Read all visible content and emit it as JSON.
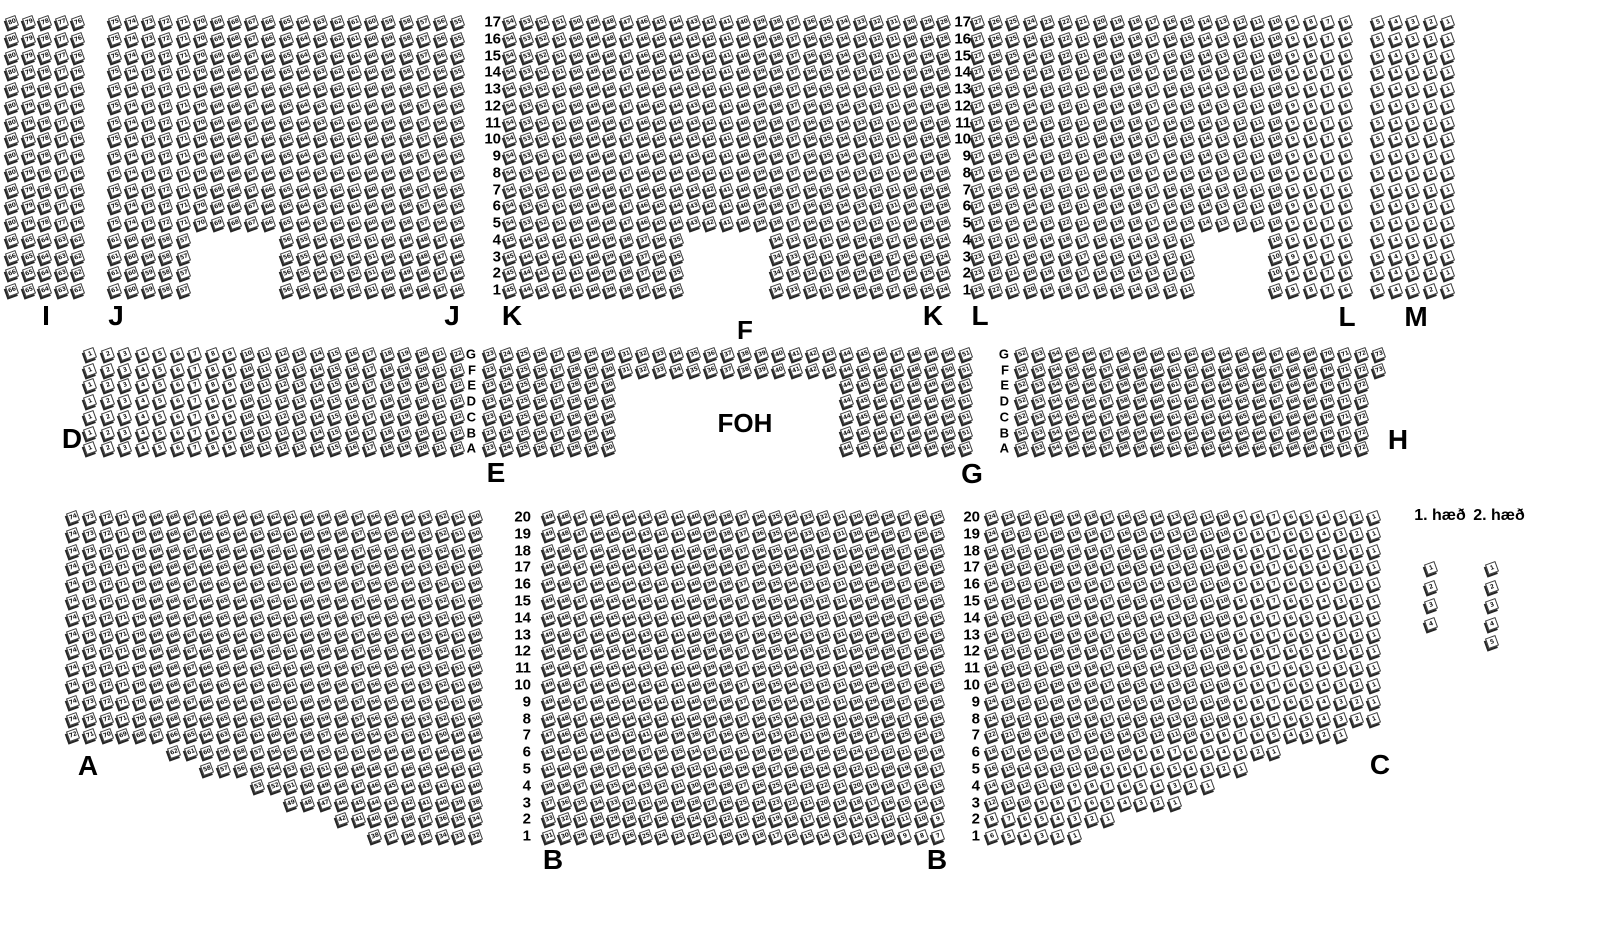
{
  "legend": {
    "floor1_label": "1. hæð",
    "floor2_label": "2. hæð"
  },
  "foh_label": "FOH",
  "colors": {
    "background": "#ffffff",
    "seat_fill": "#ffffff",
    "seat_outline": "#3a3a3a",
    "seat_shadow": "#262626",
    "text": "#000000"
  },
  "map": {
    "width": 1610,
    "height": 950,
    "section_labels": [
      {
        "text": "I",
        "x": 46,
        "y": 316
      },
      {
        "text": "J",
        "x": 116,
        "y": 316
      },
      {
        "text": "J",
        "x": 452,
        "y": 316
      },
      {
        "text": "K",
        "x": 512,
        "y": 316
      },
      {
        "text": "F",
        "x": 745,
        "y": 330,
        "size": 26
      },
      {
        "text": "K",
        "x": 933,
        "y": 316
      },
      {
        "text": "L",
        "x": 980,
        "y": 316
      },
      {
        "text": "L",
        "x": 1347,
        "y": 317
      },
      {
        "text": "M",
        "x": 1416,
        "y": 317
      },
      {
        "text": "D",
        "x": 72,
        "y": 439
      },
      {
        "text": "E",
        "x": 496,
        "y": 473
      },
      {
        "text": "FOH",
        "x": 745,
        "y": 423,
        "size": 26
      },
      {
        "text": "G",
        "x": 972,
        "y": 474
      },
      {
        "text": "H",
        "x": 1398,
        "y": 440
      },
      {
        "text": "A",
        "x": 88,
        "y": 766
      },
      {
        "text": "B",
        "x": 553,
        "y": 860
      },
      {
        "text": "B",
        "x": 937,
        "y": 860
      },
      {
        "text": "C",
        "x": 1380,
        "y": 765
      }
    ],
    "row_label_columns": [
      {
        "x": 501,
        "y": 22,
        "dy": 16.75,
        "size": 15,
        "values": [
          "17",
          "16",
          "15",
          "14",
          "13",
          "12",
          "11",
          "10",
          "9",
          "8",
          "7",
          "6",
          "5",
          "4",
          "3",
          "2",
          "1"
        ]
      },
      {
        "x": 971,
        "y": 22,
        "dy": 16.75,
        "size": 15,
        "values": [
          "17",
          "16",
          "15",
          "14",
          "13",
          "12",
          "11",
          "10",
          "9",
          "8",
          "7",
          "6",
          "5",
          "4",
          "3",
          "2",
          "1"
        ]
      },
      {
        "x": 476,
        "y": 354,
        "dy": 15.7,
        "size": 13,
        "values": [
          "G",
          "F",
          "E",
          "D",
          "C",
          "B",
          "A"
        ]
      },
      {
        "x": 1009,
        "y": 354,
        "dy": 15.7,
        "size": 13,
        "values": [
          "G",
          "F",
          "E",
          "D",
          "C",
          "B",
          "A"
        ]
      },
      {
        "x": 531,
        "y": 517,
        "dy": 16.8,
        "size": 15,
        "values": [
          "20",
          "19",
          "18",
          "17",
          "16",
          "15",
          "14",
          "13",
          "12",
          "11",
          "10",
          "9",
          "8",
          "7",
          "6",
          "5",
          "4",
          "3",
          "2",
          "1"
        ]
      },
      {
        "x": 980,
        "y": 517,
        "dy": 16.8,
        "size": 15,
        "values": [
          "20",
          "19",
          "18",
          "17",
          "16",
          "15",
          "14",
          "13",
          "12",
          "11",
          "10",
          "9",
          "8",
          "7",
          "6",
          "5",
          "4",
          "3",
          "2",
          "1"
        ]
      }
    ],
    "sections": [
      {
        "id": "I",
        "x": 12,
        "y": 22,
        "dx": 16.5,
        "dy": 16.75,
        "rows": 17,
        "cols": 5
      },
      {
        "id": "J",
        "x": 115,
        "y": 22,
        "dx": 17.15,
        "dy": 16.75,
        "rows": 17,
        "cols": 21,
        "row_ranges": {
          "13": [
            [
              0,
              4
            ],
            [
              10,
              20
            ]
          ],
          "14": [
            [
              0,
              4
            ],
            [
              10,
              20
            ]
          ],
          "15": [
            [
              0,
              4
            ],
            [
              10,
              20
            ]
          ],
          "16": [
            [
              0,
              4
            ],
            [
              10,
              20
            ]
          ]
        }
      },
      {
        "id": "K",
        "x": 510,
        "y": 22,
        "dx": 16.7,
        "dy": 16.75,
        "rows": 17,
        "cols": 27,
        "row_ranges": {
          "13": [
            [
              0,
              10
            ],
            [
              16,
              26
            ]
          ],
          "14": [
            [
              0,
              10
            ],
            [
              16,
              26
            ]
          ],
          "15": [
            [
              0,
              10
            ],
            [
              16,
              26
            ]
          ],
          "16": [
            [
              0,
              10
            ],
            [
              16,
              26
            ]
          ]
        }
      },
      {
        "id": "L",
        "x": 978,
        "y": 22,
        "dx": 17.5,
        "dy": 16.75,
        "rows": 17,
        "cols": 22,
        "row_ranges": {
          "13": [
            [
              0,
              12
            ],
            [
              17,
              21
            ]
          ],
          "14": [
            [
              0,
              12
            ],
            [
              17,
              21
            ]
          ],
          "15": [
            [
              0,
              12
            ],
            [
              17,
              21
            ]
          ],
          "16": [
            [
              0,
              12
            ],
            [
              17,
              21
            ]
          ]
        }
      },
      {
        "id": "M",
        "x": 1378,
        "y": 22,
        "dx": 17.5,
        "dy": 16.75,
        "rows": 17,
        "cols": 5
      },
      {
        "id": "D",
        "x": 90,
        "y": 354,
        "dx": 17.5,
        "dy": 15.7,
        "rows": 7,
        "cols": 22,
        "numbering": {
          "mode": "col",
          "base": 1
        }
      },
      {
        "id": "EG",
        "x": 490,
        "y": 354,
        "dx": 17.0,
        "dy": 15.7,
        "rows": 7,
        "cols": 29,
        "numbering": {
          "mode": "col",
          "base": 23
        },
        "row_ranges": {
          "2": [
            [
              0,
              7
            ],
            [
              21,
              28
            ]
          ],
          "3": [
            [
              0,
              7
            ],
            [
              21,
              28
            ]
          ],
          "4": [
            [
              0,
              7
            ],
            [
              21,
              28
            ]
          ],
          "5": [
            [
              0,
              7
            ],
            [
              21,
              28
            ]
          ],
          "6": [
            [
              0,
              7
            ],
            [
              21,
              28
            ]
          ]
        }
      },
      {
        "id": "H",
        "x": 1022,
        "y": 354,
        "dx": 17.0,
        "dy": 15.7,
        "rows": 7,
        "cols": 22,
        "numbering": {
          "mode": "col",
          "base": 52
        },
        "row_ranges": {
          "2": [
            [
              0,
              20
            ]
          ],
          "3": [
            [
              0,
              20
            ]
          ],
          "4": [
            [
              0,
              20
            ]
          ],
          "5": [
            [
              0,
              20
            ]
          ],
          "6": [
            [
              0,
              20
            ]
          ]
        }
      },
      {
        "id": "A",
        "x": 73,
        "y": 517,
        "dx": 16.8,
        "dy": 16.8,
        "rows": 20,
        "cols": 25,
        "row_ranges": {
          "14": [
            [
              6,
              24
            ]
          ],
          "15": [
            [
              8,
              24
            ]
          ],
          "16": [
            [
              11,
              24
            ]
          ],
          "17": [
            [
              13,
              24
            ]
          ],
          "18": [
            [
              16,
              24
            ]
          ],
          "19": [
            [
              18,
              24
            ]
          ]
        }
      },
      {
        "id": "B",
        "x": 549,
        "y": 517,
        "dx": 16.2,
        "dy": 16.8,
        "rows": 20,
        "cols": 25
      },
      {
        "id": "C",
        "x": 992,
        "y": 517,
        "dx": 16.6,
        "dy": 16.8,
        "rows": 20,
        "cols": 24,
        "row_ranges": {
          "13": [
            [
              0,
              21
            ]
          ],
          "14": [
            [
              0,
              17
            ]
          ],
          "15": [
            [
              0,
              15
            ]
          ],
          "16": [
            [
              0,
              13
            ]
          ],
          "17": [
            [
              0,
              11
            ]
          ],
          "18": [
            [
              0,
              7
            ]
          ],
          "19": [
            [
              0,
              5
            ]
          ]
        }
      },
      {
        "id": "stairs-1",
        "x": 1431,
        "y": 568,
        "dx": 0,
        "dy": 18.5,
        "rows": 4,
        "cols": 1,
        "numbering": {
          "mode": "row",
          "base": 1
        }
      },
      {
        "id": "stairs-2",
        "x": 1492,
        "y": 568,
        "dx": 0,
        "dy": 18.5,
        "rows": 5,
        "cols": 1,
        "numbering": {
          "mode": "row",
          "base": 1
        }
      }
    ],
    "bands": [
      {
        "mode": "rtl-chain",
        "order": [
          "M",
          "L",
          "K",
          "J",
          "I"
        ]
      },
      {
        "mode": "rtl-chain",
        "order": [
          "C",
          "B",
          "A"
        ]
      }
    ],
    "legend_positions": {
      "floor1": {
        "x": 1440,
        "y": 516
      },
      "floor2": {
        "x": 1499,
        "y": 516
      },
      "note": "stair seat columns sit below each legend label"
    }
  }
}
